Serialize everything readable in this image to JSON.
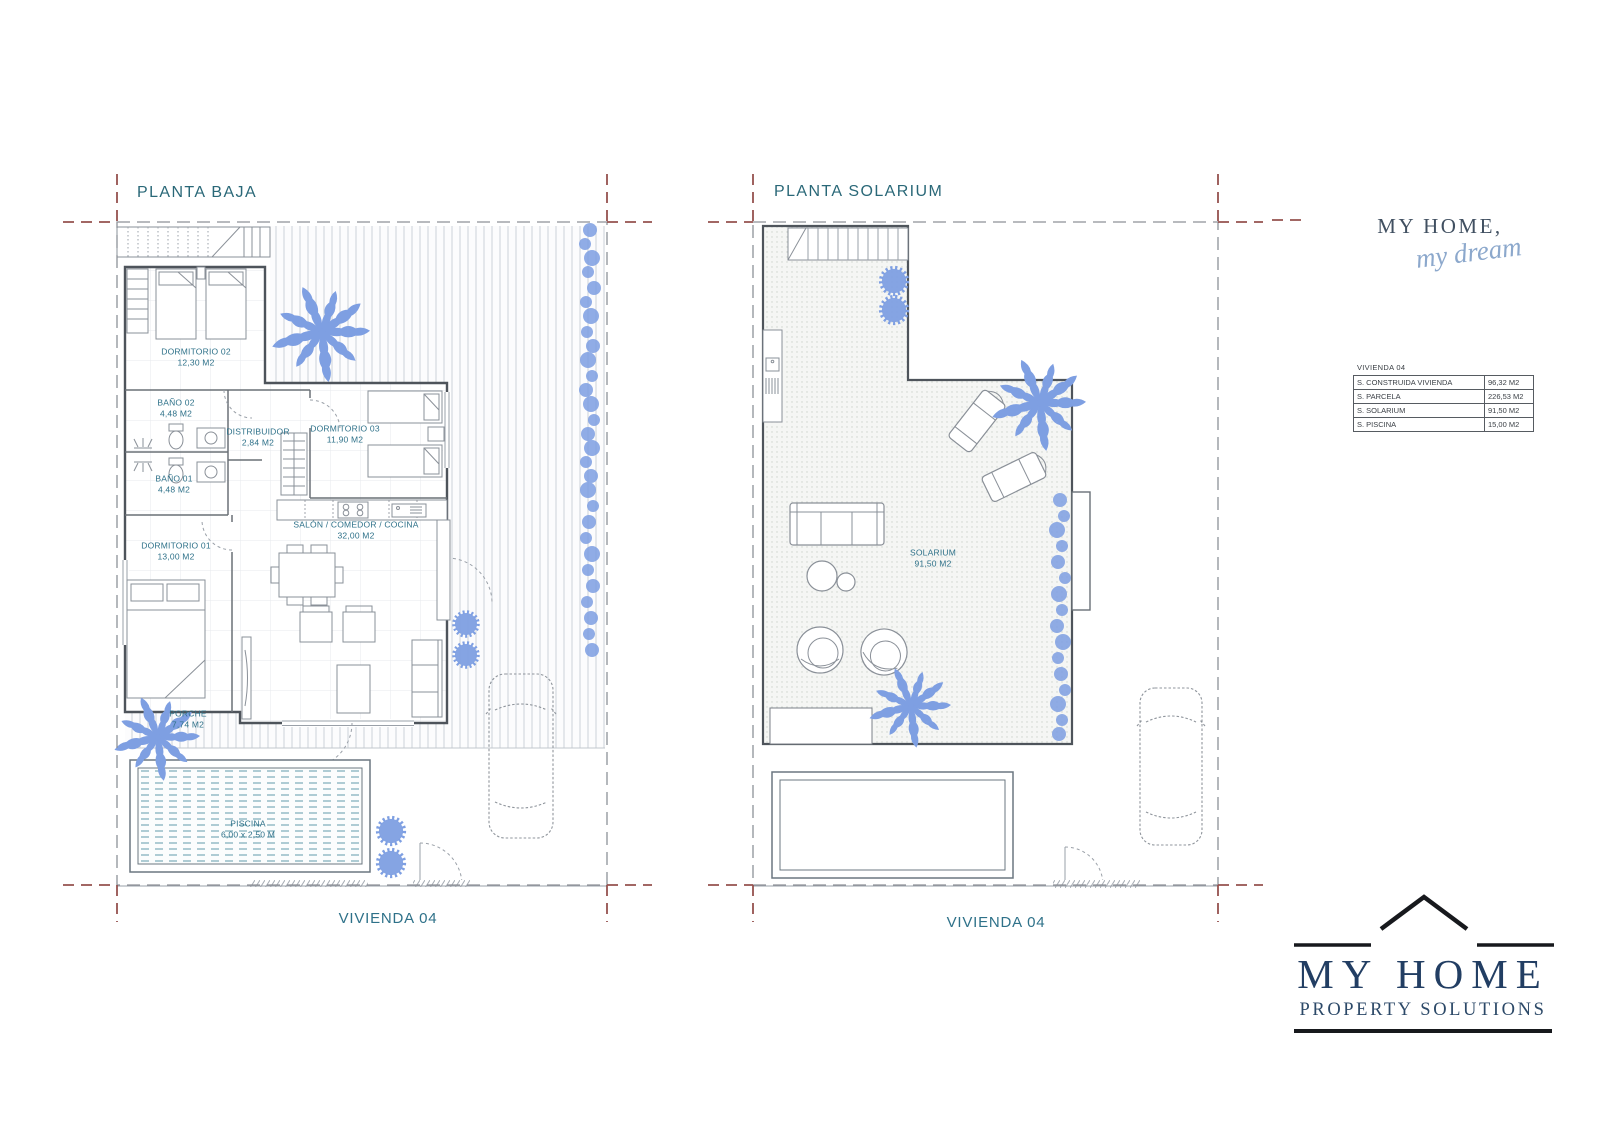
{
  "sheet": {
    "plans": {
      "baja": {
        "title": "PLANTA BAJA",
        "footer": "VIVIENDA 04",
        "rooms": [
          {
            "name": "DORMITORIO 02",
            "area": "12,30 M2"
          },
          {
            "name": "BAÑO 02",
            "area": "4,48 M2"
          },
          {
            "name": "DISTRIBUIDOR",
            "area": "2,84 M2"
          },
          {
            "name": "DORMITORIO 03",
            "area": "11,90 M2"
          },
          {
            "name": "BAÑO 01",
            "area": "4,48 M2"
          },
          {
            "name": "DORMITORIO 01",
            "area": "13,00 M2"
          },
          {
            "name": "SALÓN / COMEDOR / COCINA",
            "area": "32,00 M2"
          },
          {
            "name": "PORCHE",
            "area": "7,74 M2"
          },
          {
            "name": "PISCINA",
            "area": "6,00 x 2,50 M"
          }
        ]
      },
      "solarium": {
        "title": "PLANTA SOLARIUM",
        "footer": "VIVIENDA 04",
        "rooms": [
          {
            "name": "SOLARIUM",
            "area": "91,50 M2"
          }
        ]
      }
    },
    "brand_top": {
      "line1": "MY HOME,",
      "line2": "my dream"
    },
    "summary_table": {
      "title": "VIVIENDA 04",
      "rows": [
        {
          "label": "S. CONSTRUIDA VIVIENDA",
          "value": "96,32 M2"
        },
        {
          "label": "S. PARCELA",
          "value": "226,53 M2"
        },
        {
          "label": "S. SOLARIUM",
          "value": "91,50 M2"
        },
        {
          "label": "S. PISCINA",
          "value": "15,00 M2"
        }
      ]
    },
    "brand_bottom": {
      "name": "MY HOME",
      "tagline": "PROPERTY SOLUTIONS"
    },
    "colors": {
      "plan_text": "#2e7189",
      "title_text": "#2a6878",
      "vegetation": "#7e9fe2",
      "pool_water": "#84b2bd",
      "logo_navy": "#223e63",
      "script_blue": "#8ca8cc",
      "boundary_accent": "#95524f"
    }
  }
}
